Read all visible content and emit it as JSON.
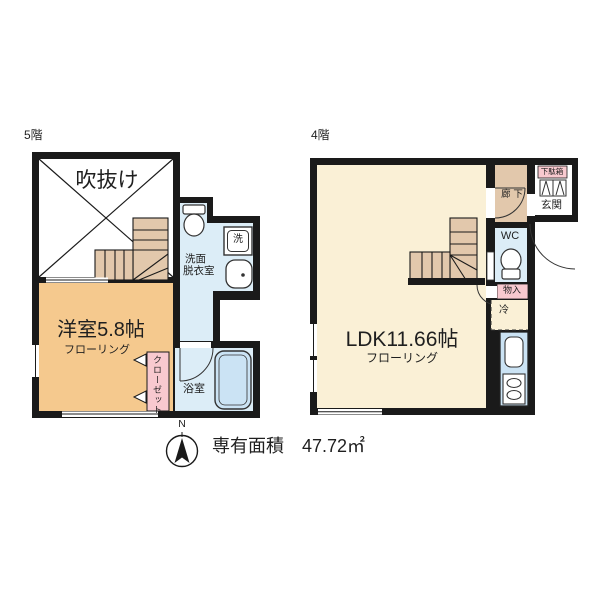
{
  "legend": {
    "north": "N",
    "area_label": "専有面積",
    "area_value": "47.72㎡"
  },
  "floor5": {
    "label": "5階",
    "rooms": {
      "void": "吹抜け",
      "bedroom": "洋室5.8帖",
      "bedroom_floor": "フローリング",
      "closet": "クローゼット",
      "washroom_line1": "洗面",
      "washroom_line2": "脱衣室",
      "washer": "洗",
      "bath": "浴室"
    }
  },
  "floor4": {
    "label": "4階",
    "rooms": {
      "ldk": "LDK11.66帖",
      "ldk_floor": "フローリング",
      "hallway": "廊 下",
      "shoe_cabinet": "下駄箱",
      "entrance": "玄関",
      "wc": "WC",
      "storage": "物入",
      "fridge": "冷"
    }
  },
  "colors": {
    "wall": "#1a1a1a",
    "bedroom_orange": "#F5C98E",
    "ldk_cream": "#FAF0D6",
    "stair_tan": "#E2C8AC",
    "water_blue": "#DCEDF7",
    "fixture_blue": "#CBE3F4",
    "pink": "#F8C9CF",
    "white": "#FFFFFF"
  }
}
